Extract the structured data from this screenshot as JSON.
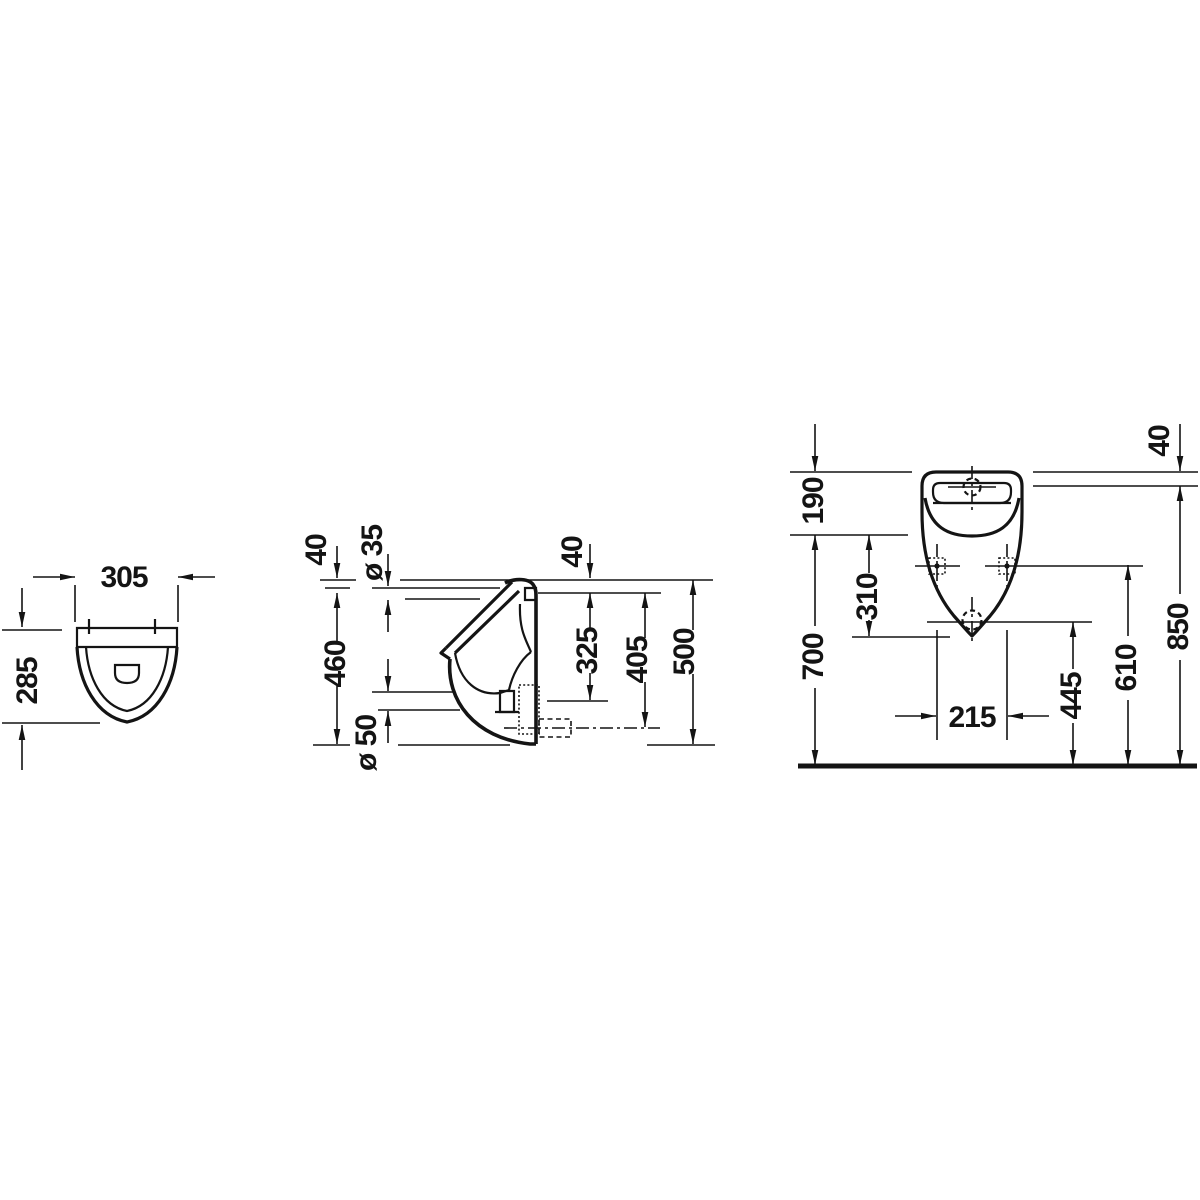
{
  "drawing": {
    "type": "technical-dimension-drawing",
    "subject": "wall-mounted urinal, three orthographic views with installation dimensions (mm)",
    "colors": {
      "line": "#141414",
      "background": "#ffffff"
    },
    "views": {
      "top": {
        "label": "top-view",
        "width": "305",
        "depth": "285"
      },
      "side": {
        "label": "side-view",
        "rim_to_inlet": "40",
        "inlet_diameter": "ø 35",
        "inlet_to_bottom": "460",
        "drain_diameter": "ø 50",
        "rim_to_inlet_right": "40",
        "inlet_to_drain": "325",
        "inlet_to_outlet": "405",
        "total_height": "500"
      },
      "front": {
        "label": "front-view",
        "top_to_inlet": "40",
        "top_to_rim": "190",
        "rim_to_tip": "310",
        "floor_to_rim": "700",
        "fixing_hole_spacing": "215",
        "floor_to_outlet": "445",
        "floor_to_fixing_holes": "610",
        "floor_to_inlet": "850"
      }
    }
  }
}
